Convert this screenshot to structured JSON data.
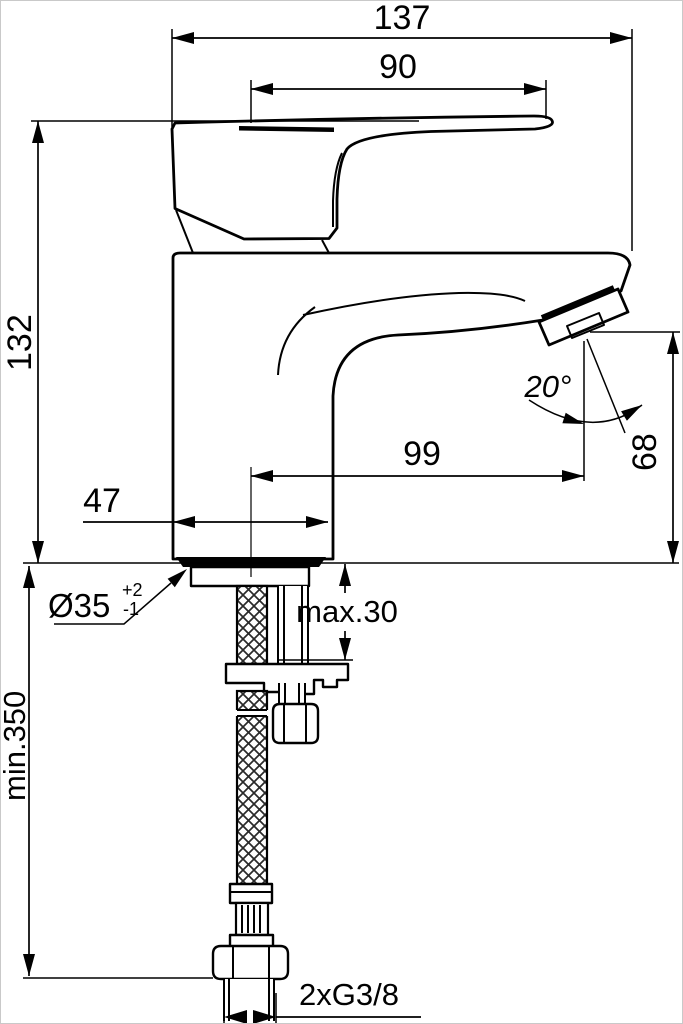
{
  "colors": {
    "line": "#010101",
    "background": "#ffffff"
  },
  "dims": {
    "total_width": "137",
    "handle_length": "90",
    "height_above_deck": "132",
    "body_depth": "47",
    "spout_reach": "99",
    "spout_angle": "20°",
    "outlet_height": "68",
    "hole_diameter": "Ø35",
    "hole_tol_plus": "+2",
    "hole_tol_minus": "-1",
    "max_deck_thickness": "max.30",
    "min_hose_length": "min.350",
    "connection_thread": "2xG3/8"
  }
}
